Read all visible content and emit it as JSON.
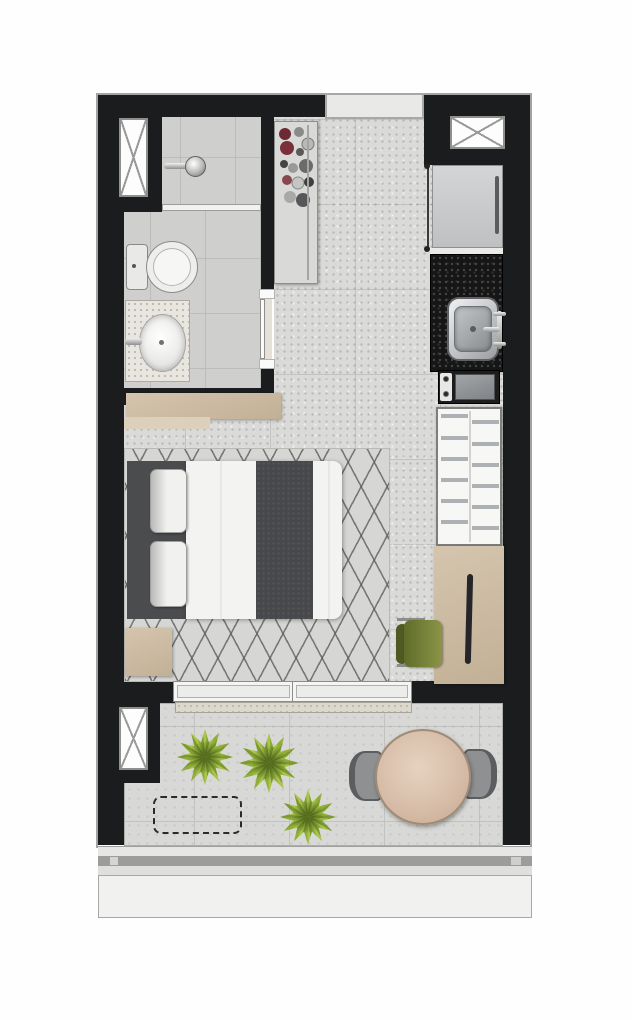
{
  "app": {
    "type": "studio-apartment-floor-plan-rendering",
    "visible_text": []
  },
  "colors": {
    "wall": "#1b1c1e",
    "floor-main": "#dadad8",
    "floor-grout": "#c3c3c1",
    "floor-bath": "#cfcfcd",
    "floor-balcony": "#d8d8d6",
    "rug-base": "#d6d6d4",
    "wood": "#c2b096",
    "wood-light": "#d5c5ae",
    "counter-stone": "#161616",
    "unit-white": "#f7f7f5",
    "plant-a": "#a9c44a",
    "plant-b": "#8fae3a",
    "plant-dark": "#7c9a2e",
    "table-wood": "#d5bba6",
    "chair-gray": "#8f9092",
    "chair-green": "#4e5a22",
    "fabric-white": "#f3f3f1",
    "fabric-dark": "#47484c",
    "headboard": "#4b4c4e",
    "sill": "#ddd8cc",
    "rail-gray": "#9c9c9a",
    "ledge-white": "#f1f1ef",
    "window-frame": "#8f8f8d",
    "glass-white": "#fdfdfd"
  },
  "plan": {
    "zones": [
      {
        "name": "bathroom",
        "fixtures": [
          "left-window",
          "walk-in-shower",
          "glass-partition",
          "toilet",
          "washbasin-vanity",
          "pocket-door"
        ]
      },
      {
        "name": "entry",
        "fixtures": [
          "entry-door",
          "wardrobe-with-clothes"
        ]
      },
      {
        "name": "kitchen",
        "fixtures": [
          "top-right-window",
          "refrigerator",
          "black-stone-counter",
          "stainless-sink",
          "two-burner-cooktop",
          "white-shelf-unit"
        ]
      },
      {
        "name": "living-sleeping-area",
        "fixtures": [
          "wood-console",
          "double-bed",
          "pillows",
          "dark-bed-runner",
          "diamond-pattern-rug",
          "nightstand",
          "wood-desk",
          "green-desk-chair"
        ]
      },
      {
        "name": "balcony",
        "fixtures": [
          "sliding-glass-door",
          "balcony-window",
          "three-plants",
          "dashed-planting-zone",
          "round-wood-table",
          "two-gray-chairs",
          "railing",
          "outer-ledge"
        ]
      }
    ]
  }
}
